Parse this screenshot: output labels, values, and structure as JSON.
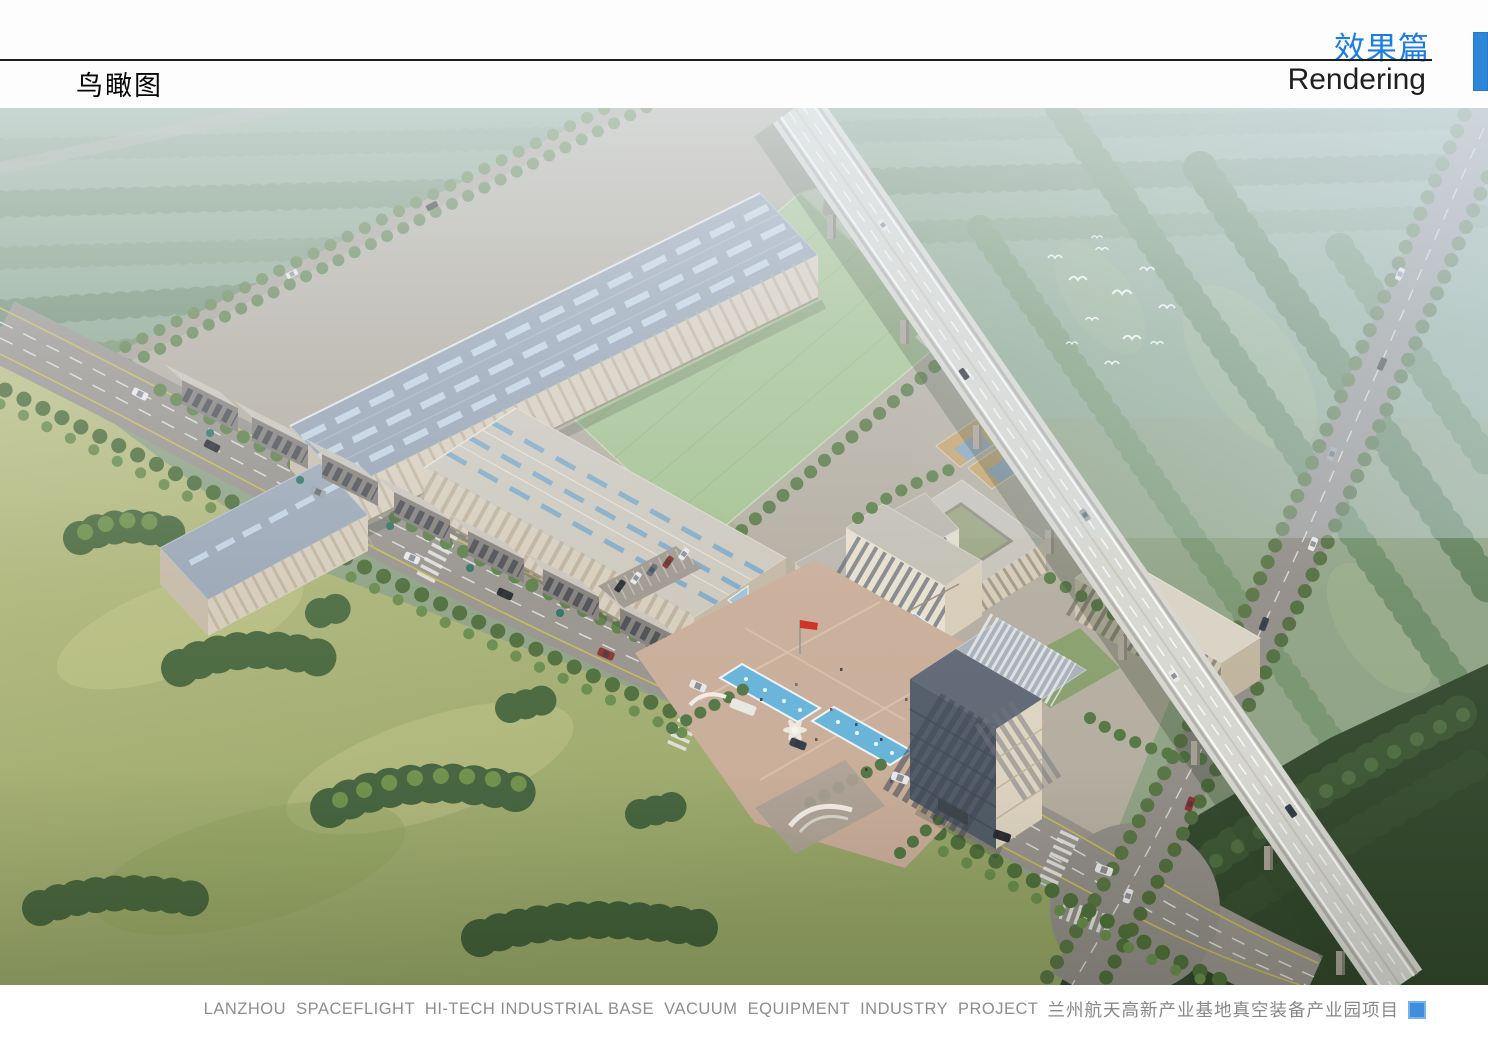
{
  "header": {
    "section_title_cn": "效果篇",
    "section_title_en": "Rendering",
    "page_title_cn": "鸟瞰图"
  },
  "footer": {
    "caption_en": "LANZHOU  SPACEFLIGHT  HI-TECH INDUSTRIAL BASE  VACUUM  EQUIPMENT  INDUSTRY  PROJECT",
    "caption_cn": "兰州航天高新产业基地真空装备产业园项目"
  },
  "colors": {
    "accent_blue_text": "#1b7ce2",
    "accent_bar_blue": "#2e86d9",
    "caption_marker_blue": "#3f8ede",
    "caption_gray": "#8d8d8d",
    "header_rule_black": "#1d1d1d"
  },
  "scene": {
    "type": "architectural-aerial-rendering",
    "subject": "Bird's-eye view of an industrial park campus",
    "elements": [
      "large factory workshop with blue-gray roof",
      "second factory workshop with skylight strips",
      "row of two-story workshop buildings along main road",
      "translucent green sports field with sawtooth glass fence",
      "courtyard office building with basketball courts",
      "main office building with glass entrance canopy",
      "high-rise tower with roof terrace",
      "dormitory block",
      "entry plaza with two fountain pools, sculpture and red flag",
      "parking lot with cars",
      "elevated expressway viaduct on piers",
      "tree-lined arterial roads with traffic and zebra crossings",
      "meadow with tree clusters",
      "dense forest belts",
      "flock of white birds",
      "atmospheric haze"
    ]
  }
}
